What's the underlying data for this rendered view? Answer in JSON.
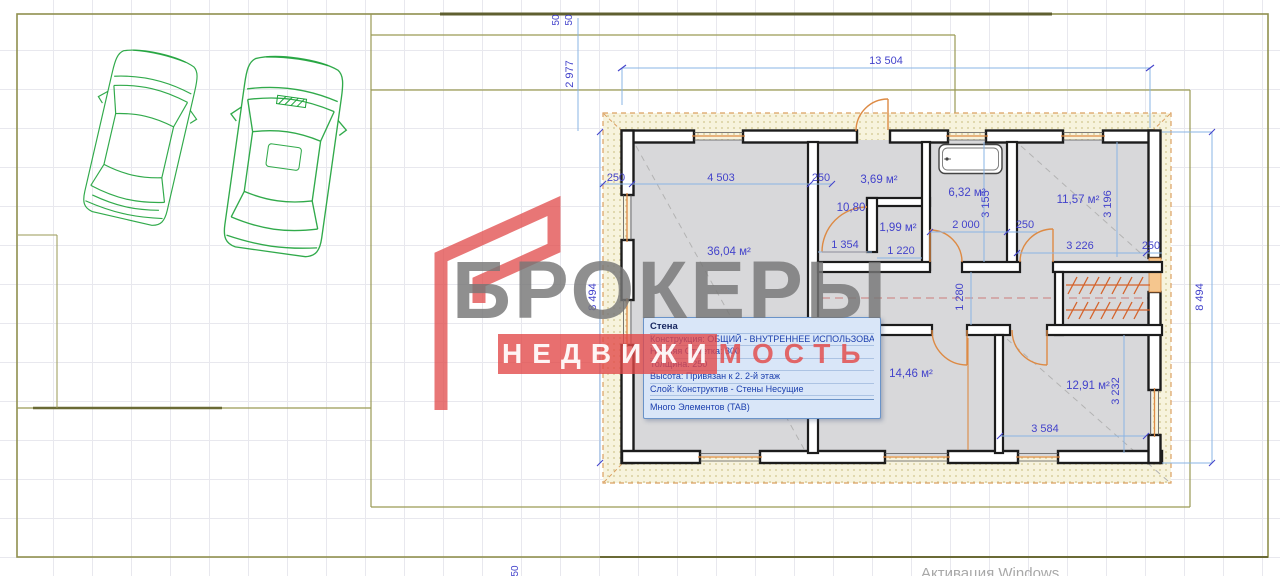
{
  "rooms": {
    "living": "36,04 м²",
    "entry": "3,69 м²",
    "hall": "10,80",
    "wc": "1,99 м²",
    "bath": "6,32 м²",
    "bedroom1": "11,57 м²",
    "kitchen": "14,46 м²",
    "bedroom2": "12,91 м²"
  },
  "dims": {
    "total_width": "13 504",
    "site_offset_v": "2 977",
    "gap1": "50",
    "gap2": "50",
    "gap_bottom": "50",
    "height_left": "8 494",
    "height_right": "8 494",
    "wall_a": "250",
    "living_w": "4 503",
    "wall_b": "250",
    "hall_w": "1 354",
    "wc_w": "1 220",
    "bath_w": "2 000",
    "wall_c": "250",
    "bath_h": "3 155",
    "bed1_h": "3 196",
    "bed1_w": "3 226",
    "wall_d": "250",
    "corridor_w": "1 280",
    "bed2_w": "3 584",
    "bed2_h": "3 232"
  },
  "tooltip": {
    "title": "Стена",
    "rows": [
      "Конструкция: ОБЩИЙ - ВНУТРЕННЕЕ ИСПОЛЬЗОВАНИЕ",
      "Нижняя Отметка: 300",
      "Толщина: 250",
      "Высота: Привязан к 2. 2-й этаж",
      "Слой: Конструктив - Стены Несущие"
    ],
    "footer": "Много Элементов (TAB)"
  },
  "watermark": {
    "brand_top": "БРОКЕРЫ",
    "brand_bottom_highlight": "НЕДВИЖИ",
    "brand_bottom_rest": "МОСТЬ"
  },
  "os": {
    "activation": "Активация Windows"
  },
  "colors": {
    "dimension_text": "#4343cb",
    "dimension_line": "#8ab4e4",
    "wall": "#1c1c1c",
    "room_fill": "#d8d8da",
    "band_fill": "#f7f3dd",
    "door_orange": "#dd8a44",
    "stairs_orange": "#d4622a",
    "site_olive": "#9a9a55",
    "car_green": "#1fa33c",
    "watermark_gray": "#767676",
    "watermark_red": "#e24f4f",
    "tooltip_bg": "#d9e6f8"
  }
}
